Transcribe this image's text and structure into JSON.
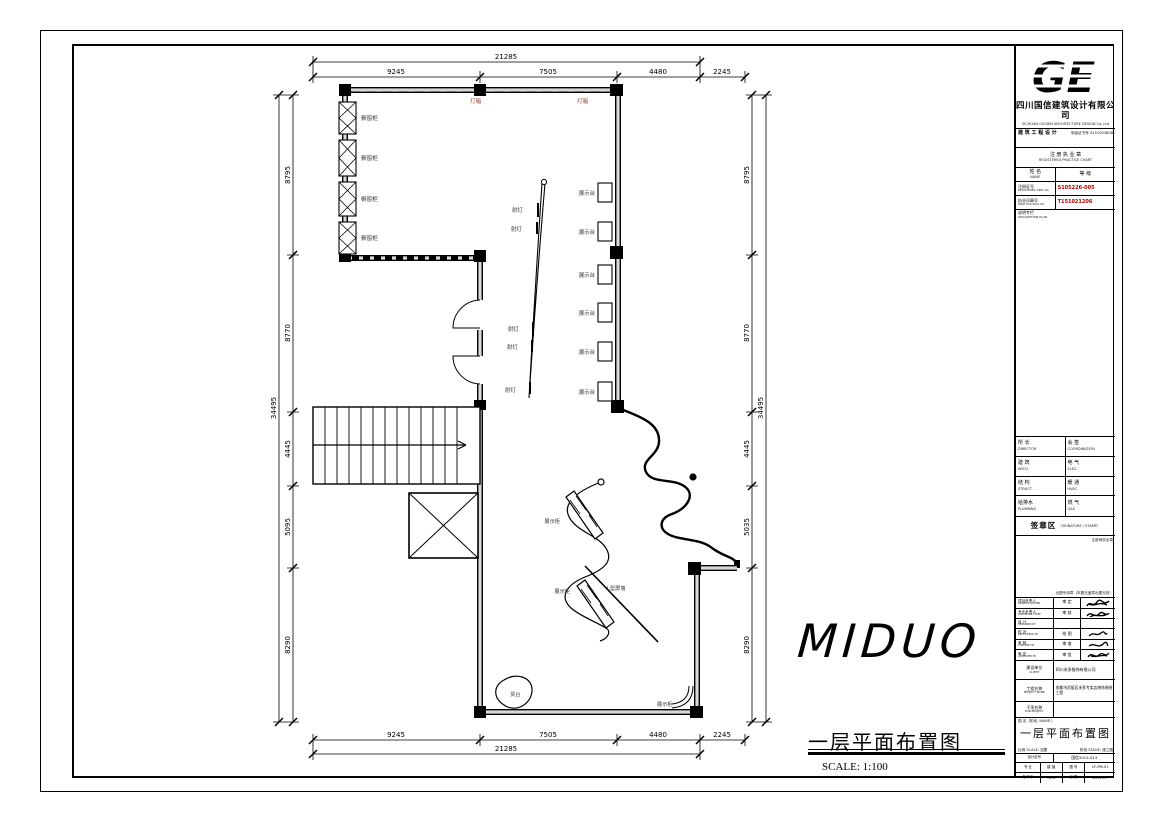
{
  "sheet": {
    "brand_text": "MIDUO",
    "drawing_title": "一层平面布置图",
    "drawing_scale": "SCALE: 1:100"
  },
  "plan": {
    "labels": {
      "window_box": "橱窗柜",
      "light_box": "灯箱",
      "spot_light": "射灯",
      "display_stand": "展示台",
      "display_cabinet": "展示柜",
      "screen_wall": "L型屏墙",
      "counter": "货台"
    },
    "dims": {
      "top": {
        "overall": "21285",
        "segments": [
          "9245",
          "7505",
          "4480",
          "2245"
        ]
      },
      "bottom": {
        "overall": "21285",
        "segments": [
          "9245",
          "7505",
          "4480",
          "2245"
        ]
      },
      "left": {
        "overall": "34495",
        "segments": [
          "8795",
          "8770",
          "4445",
          "5095",
          "8290"
        ]
      },
      "right": {
        "overall": "34495",
        "segments": [
          "8795",
          "8770",
          "4445",
          "5035",
          "8290"
        ]
      }
    }
  },
  "titleblock": {
    "logo_text": "GE",
    "company": "四川国信建筑设计有限公司",
    "company_en": "SICHUAN GUOXIN ARCHITECTURE DESIGN Co.,Ltd",
    "cert_left": "建 筑 工 程 设 计",
    "cert_right": "甲级证书号 A151003808",
    "practice_cn": "注 册 执 业 章",
    "practice_en": "REGISTERED PRACTICE CHART",
    "name_cn": "姓 名",
    "name_en": "NAME",
    "grade_cn": "等 级",
    "regno_cn": "注册证号",
    "regno_en": "REGISTERED CERT No.",
    "regno_val": "S105226-005",
    "sealno_cn": "执业印章号",
    "sealno_en": "PRACTICE SEAL No.",
    "sealno_val": "T151021206",
    "desc_cn": "说明专栏",
    "desc_en": "DESCRIPTION PLAN",
    "signoff_rows": [
      {
        "l_cn": "所 长",
        "l_en": "DIRECTOR",
        "r_cn": "会 签",
        "r_en": "COORDINATION"
      },
      {
        "l_cn": "建 筑",
        "l_en": "ARCH.",
        "r_cn": "电 气",
        "r_en": "ELEC."
      },
      {
        "l_cn": "结 构",
        "l_en": "STRUCT.",
        "r_cn": "暖 通",
        "r_en": "HVAC"
      },
      {
        "l_cn": "给排水",
        "l_en": "PLUMBING",
        "r_cn": "燃 气",
        "r_en": "GAS"
      }
    ],
    "stamp_cn": "签章区",
    "stamp_en": "（SIGNATURE / STAMP）",
    "reg_seal_note": "注册师执业章",
    "plot_stamp_note": "出图专用章（本图无盖章出图无效）",
    "sig_rows": [
      {
        "c1_cn": "项目负责人",
        "c1_en": "PROJECT LEADER",
        "c2": "审 定"
      },
      {
        "c1_cn": "专业负责人",
        "c1_en": "DISCIPLINE CHIEF",
        "c2": "审 核"
      },
      {
        "c1_cn": "设 计",
        "c1_en": "DESIGNED BY",
        "c2": ""
      },
      {
        "c1_cn": "校 对",
        "c1_en": "PROOFREAD BY",
        "c2": "绘 图"
      },
      {
        "c1_cn": "审 核",
        "c1_en": "CHECKED BY",
        "c2": "审 查"
      },
      {
        "c1_cn": "审 定",
        "c1_en": "APPROVED BY",
        "c2": "审 批"
      }
    ],
    "client_cn": "建设单位",
    "client_en": "CLIENT",
    "client_val": "四川米多服饰有限公司",
    "project_cn": "工程名称",
    "project_en": "PROJECT NAME",
    "project_val": "成都市武侯区米多专卖店装饰装修工程",
    "sub_cn": "子项名称",
    "sub_en": "SUB-PROJECT",
    "sub_val": "",
    "figname_label": "图 名（阶段, NAME:）",
    "fig_title": "一层平面布置图",
    "scale_label": "比例 SCALE:",
    "scale_val": "如图",
    "stage_label": "阶段 STAGE:",
    "stage_val": "施工图",
    "certno_cn": "设计证号",
    "certno_en": "PROJECT No.",
    "certno_val": "国信2012-013",
    "disc_cn": "专 业",
    "disc_en": "DISC.",
    "disc_val": "建 施",
    "dwg_cn": "图 号",
    "dwg_en": "DWG No.",
    "dwg_val": "1F-PM-01",
    "rev_cn": "版本号",
    "rev_en": "REV.",
    "rev_val": "01.0",
    "date_cn": "日 期",
    "date_en": "DATE",
    "date_val": "2012.07"
  }
}
